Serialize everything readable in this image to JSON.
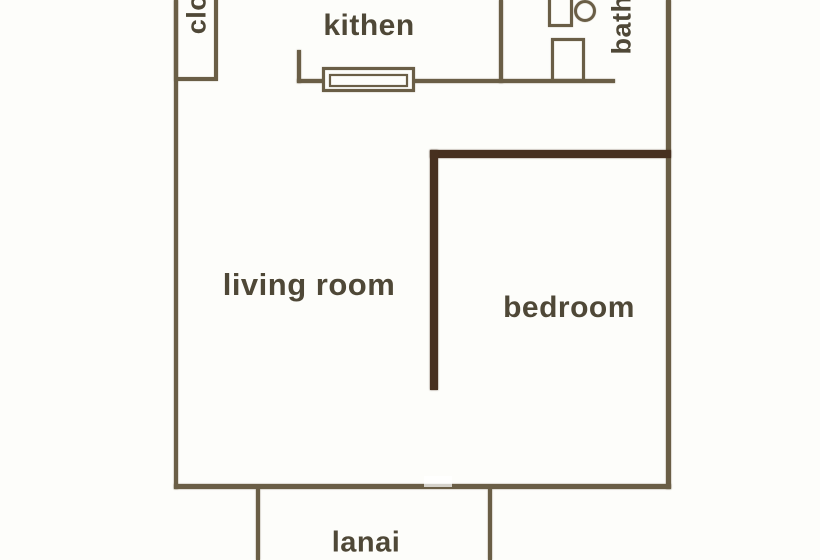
{
  "diagram": {
    "type": "apartment-floor-plan",
    "colors": {
      "background": "#fdfdfa",
      "wall": "#6a5e46",
      "wall_dark": "#47301f",
      "label_text": "#4f4837"
    },
    "rooms": {
      "closet_label": "clo",
      "kitchen_label": "kithen",
      "bath_label": "bath",
      "living_room_label": "living room",
      "bedroom_label": "bedroom",
      "lanai_label": "lanai"
    },
    "fixtures": [
      "closet-box",
      "kitchen-counter",
      "toilet-tank",
      "toilet-bowl",
      "bath-sink"
    ],
    "notes": "labels for closet and bath are rotated 90deg counter-clockwise; bedroom wall drawn darker/thicker"
  }
}
